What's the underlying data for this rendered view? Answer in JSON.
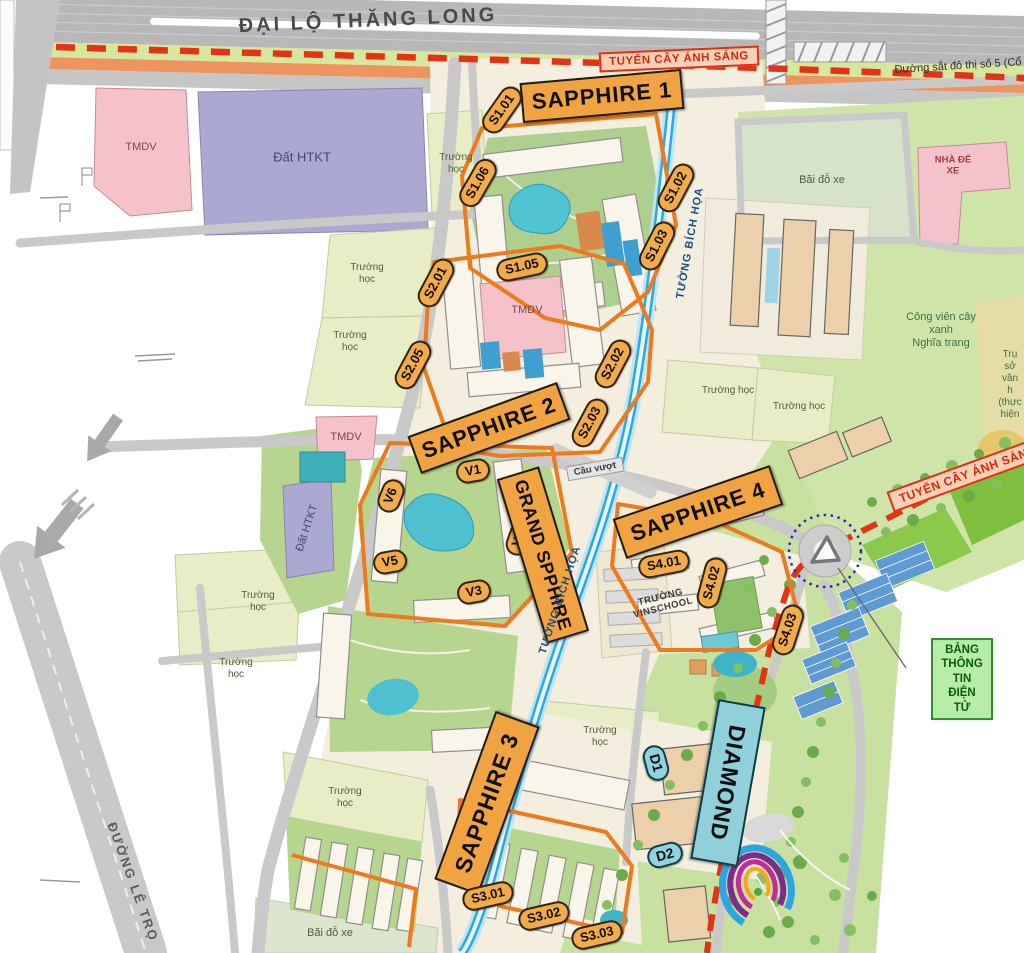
{
  "labels": {
    "road_thang_long": "ĐẠI LỘ THĂNG LONG",
    "light_route": "TUYẾN CÂY ÁNH SÁNG",
    "railway": "Đường sắt đô thị số 5 (Cổ",
    "tmdv": "TMDV",
    "dat_htkt": "Đất HTKT",
    "school": "Trường học",
    "parking": "Bãi đỗ xe",
    "garage": "NHÀ ĐỂ\nXE",
    "park_cemetery": "Công viên cây xanh\nNghĩa trang",
    "hq": "Trụ sở\nvăn h\n(thực hiện",
    "info_board": "BẢNG THÔNG TIN\nĐIỆN TỬ",
    "mural": "TƯỜNG BÍCH HỌA",
    "overpass": "Cầu vượt",
    "vinschool": "TRƯỜNG\nVINSCHOOL",
    "road_le_trong": "ĐƯỜNG LÊ TRỌ"
  },
  "zones": {
    "s1": "SAPPHIRE 1",
    "s2": "SAPPHIRE 2",
    "s3": "SAPPHIRE 3",
    "s4": "SAPPHIRE 4",
    "grand": "GRAND SPPHIRE",
    "diamond": "DIAMOND"
  },
  "plots": {
    "s101": "S1.01",
    "s102": "S1.02",
    "s103": "S1.03",
    "s105": "S1.05",
    "s106": "S1.06",
    "s201": "S2.01",
    "s202": "S2.02",
    "s203": "S2.03",
    "s205": "S2.05",
    "s301": "S3.01",
    "s302": "S3.02",
    "s303": "S3.03",
    "s401": "S4.01",
    "s402": "S4.02",
    "s403": "S4.03",
    "v1": "V1",
    "v2": "V2",
    "v3": "V3",
    "v5": "V5",
    "v6": "V6",
    "d1": "D1",
    "d2": "D2"
  },
  "colors": {
    "zone_banner_orange": "#f0a340",
    "zone_outline_orange": "#ee7a1e",
    "diamond_cyan": "#8fd0da",
    "light_route_red": "#e63214",
    "mural_wall_blue": "#2aa9e0",
    "info_board_green": "#2f8f2f",
    "parcel_cream": "#f3eedd",
    "park_green": "#cfe4a9"
  }
}
